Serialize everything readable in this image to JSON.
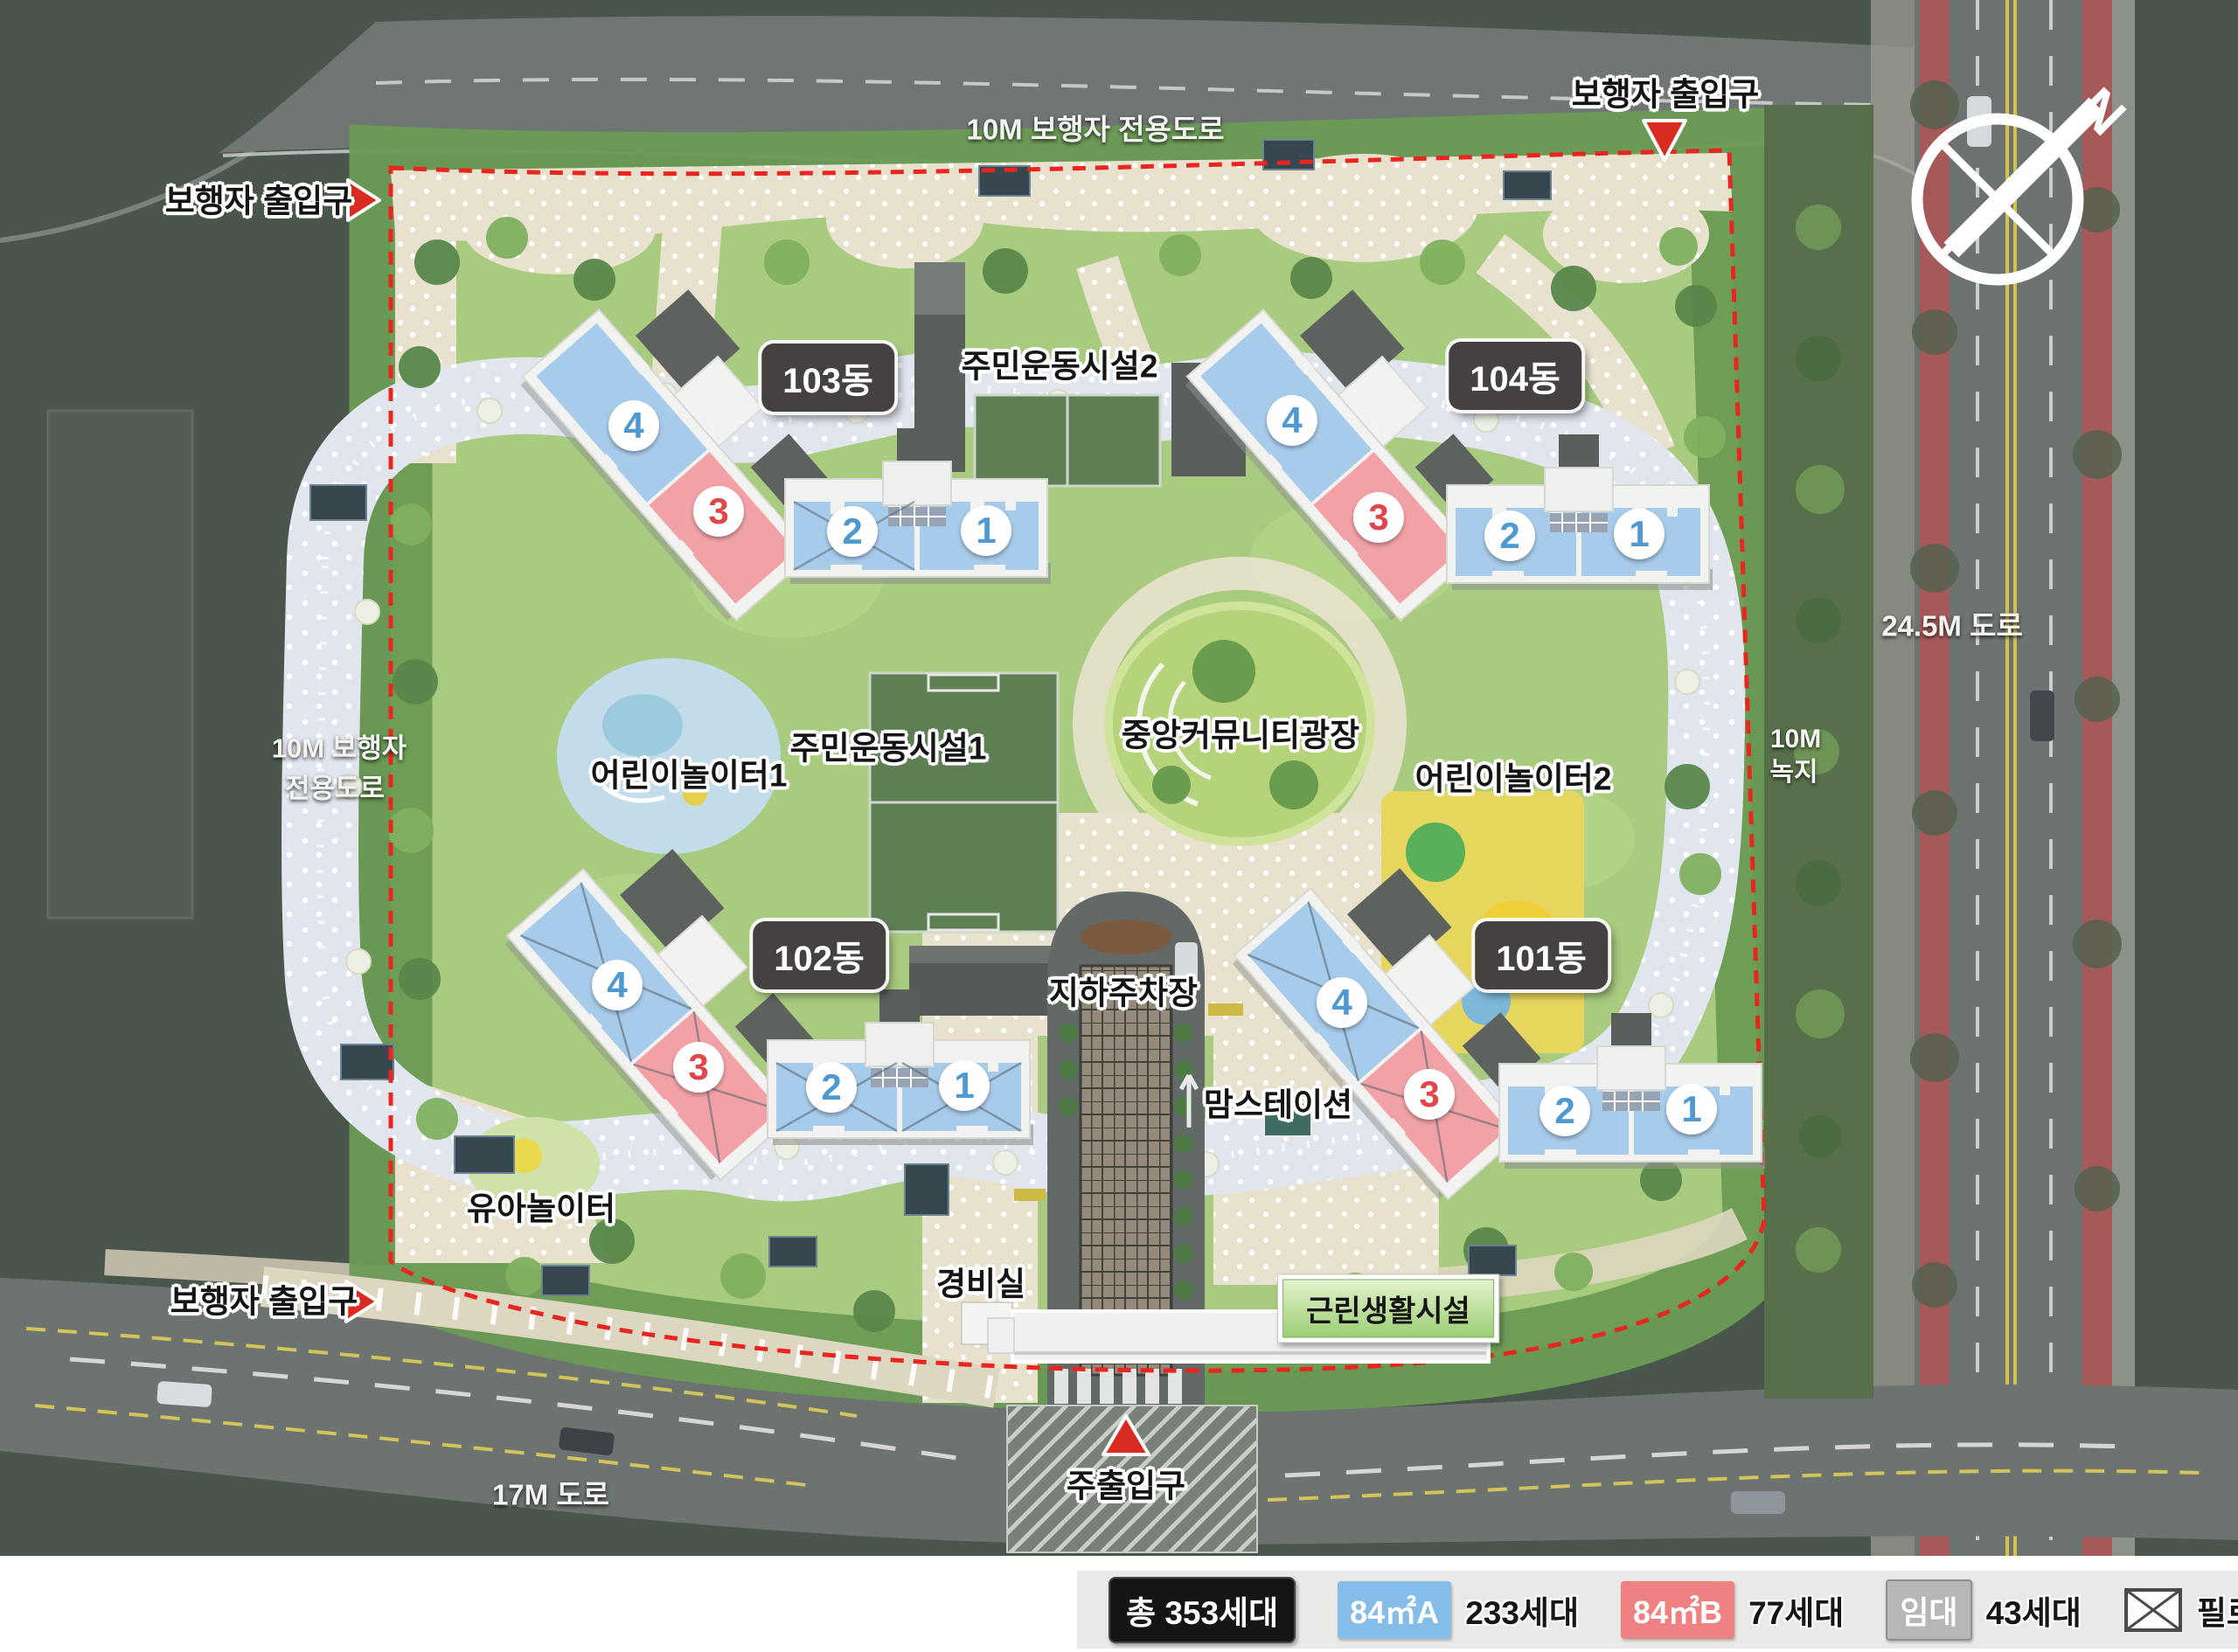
{
  "map": {
    "roads": {
      "top": "10M 보행자 전용도로",
      "left_line1": "10M 보행자",
      "left_line2": "전용도로",
      "right": "24.5M 도로",
      "green_line1": "10M",
      "green_line2": "녹지",
      "bottom": "17M 도로"
    },
    "entrances": {
      "pedestrian": "보행자 출입구",
      "main": "주출입구"
    },
    "facilities": {
      "sports2": "주민운동시설2",
      "sports1": "주민운동시설1",
      "plaza": "중앙커뮤니티광장",
      "playground1": "어린이놀이터1",
      "playground2": "어린이놀이터2",
      "parking": "지하주차장",
      "mom_station": "맘스테이션",
      "toddler_playground": "유아놀이터",
      "guard_office": "경비실",
      "retail": "근린생활시설"
    },
    "buildings": [
      {
        "name": "103동",
        "units": [
          "4",
          "3",
          "2",
          "1"
        ]
      },
      {
        "name": "104동",
        "units": [
          "4",
          "3",
          "2",
          "1"
        ]
      },
      {
        "name": "102동",
        "units": [
          "4",
          "3",
          "2",
          "1"
        ]
      },
      {
        "name": "101동",
        "units": [
          "4",
          "3",
          "2",
          "1"
        ]
      }
    ],
    "compass_n": "N"
  },
  "legend": {
    "total": "총 353세대",
    "items": [
      {
        "tag": "84㎡A",
        "count": "233세대",
        "color": "#85bce8"
      },
      {
        "tag": "84㎡B",
        "count": "77세대",
        "color": "#ef8183"
      },
      {
        "tag": "임대",
        "count": "43세대",
        "color": "#b7b7b7"
      }
    ],
    "piloti": "필로티"
  },
  "colors": {
    "unit_a_fill": "#a7cbea",
    "unit_b_fill": "#f2a2a6",
    "unit_a_number": "#4f99d3",
    "unit_b_number": "#e0474b",
    "boundary_dash": "#e8251f",
    "entrance_arrow": "#da2b20",
    "site_green": "#a9cb7f",
    "outside_green": "#4a564c",
    "road_gray": "#6d7370"
  }
}
